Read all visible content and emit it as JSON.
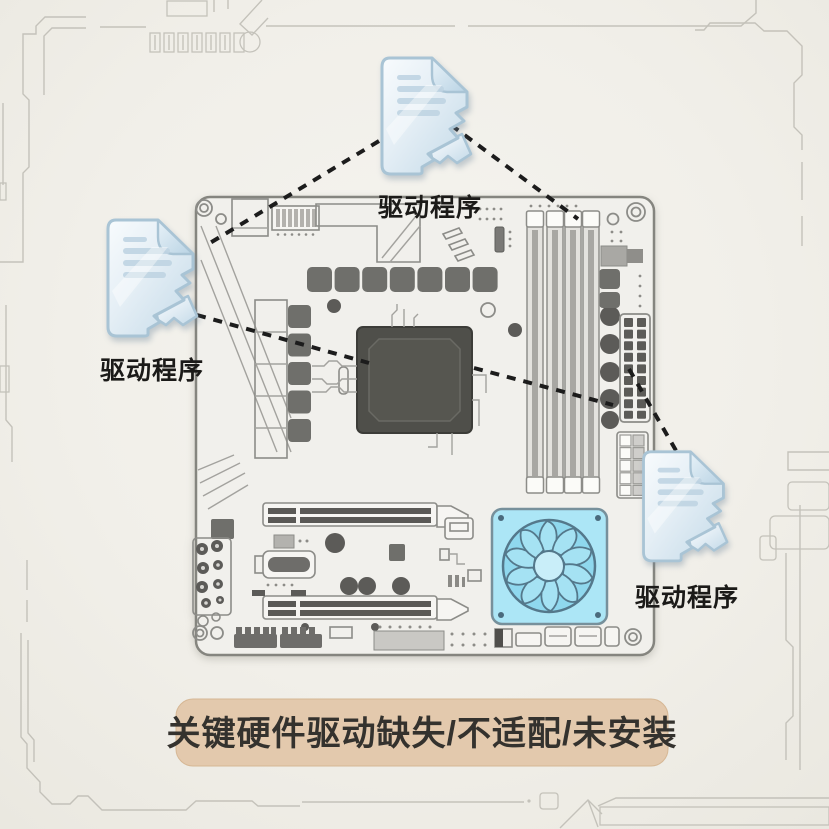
{
  "canvas": {
    "width": 829,
    "height": 829,
    "background_color": "#efede7"
  },
  "caption": {
    "text": "关键硬件驱动缺失/不适配/未安装",
    "background_color": "#e3c9ad",
    "text_color": "#34322e"
  },
  "documents": [
    {
      "position": "top",
      "label": "驱动程序"
    },
    {
      "position": "left",
      "label": "驱动程序"
    },
    {
      "position": "right",
      "label": "驱动程序"
    }
  ],
  "document_style": {
    "tint_color": "#cfe3ef",
    "outline_color": "#a9c4d5",
    "appearance": "torn-glassy-file"
  },
  "connector_style": {
    "line_color": "#1c1c1c",
    "dash_pattern": "9 8",
    "line_count": 5
  },
  "motherboard": {
    "board_color": "#f1f0ec",
    "outline_color": "#85857f",
    "component_color": "#6f6f6b",
    "cpu_color": "#4f4f4a",
    "fan_body_color": "#ace6f6",
    "fan_blade_color": "#8fd8ee",
    "fan_outline_color": "#54788b"
  }
}
